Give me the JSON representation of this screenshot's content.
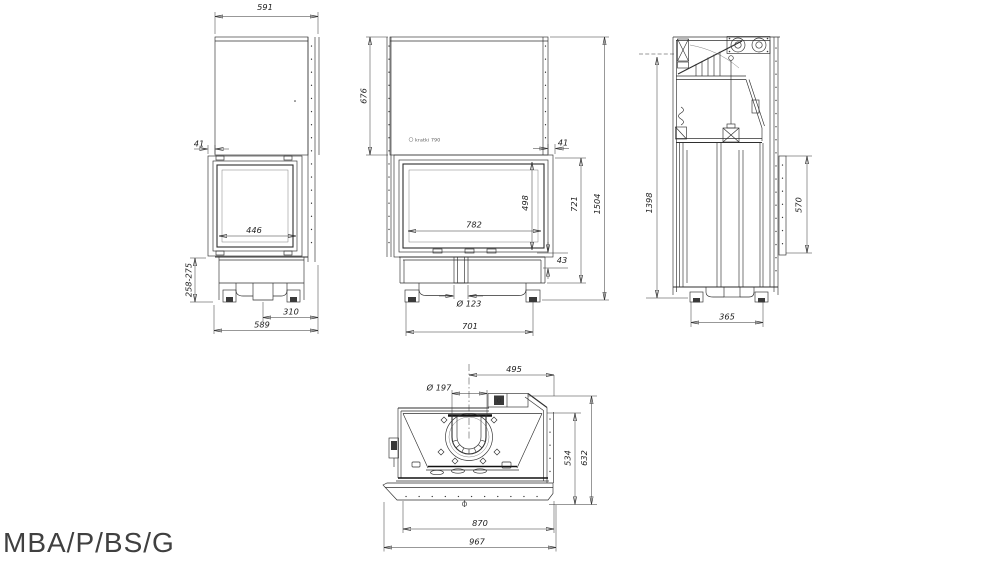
{
  "label": {
    "model": "MBA/P/BS/G"
  },
  "logo": {
    "text": "kratki 790"
  },
  "colors": {
    "line": "#2f2f2f",
    "background": "#ffffff",
    "label_text": "#404040"
  },
  "views": {
    "left_side": {
      "top_width": "591",
      "frame_offset": "41",
      "glass_width": "446",
      "plinth_height": "258-275",
      "flue_axis_to_back": "310",
      "base_depth": "589"
    },
    "front": {
      "hood_height": "676",
      "frame_offset": "41",
      "glass_width": "782",
      "glass_height": "498",
      "firebox_height": "721",
      "total_height": "1504",
      "frame_lip": "43",
      "inlet_diameter": "Ø 123",
      "base_width": "701"
    },
    "right_side": {
      "body_height": "1398",
      "rear_panel_height": "570",
      "base_depth": "365"
    },
    "top": {
      "flue_axis_to_front": "495",
      "flue_diameter": "Ø 197",
      "body_depth": "534",
      "total_depth": "632",
      "body_width": "870",
      "total_width": "967"
    }
  }
}
